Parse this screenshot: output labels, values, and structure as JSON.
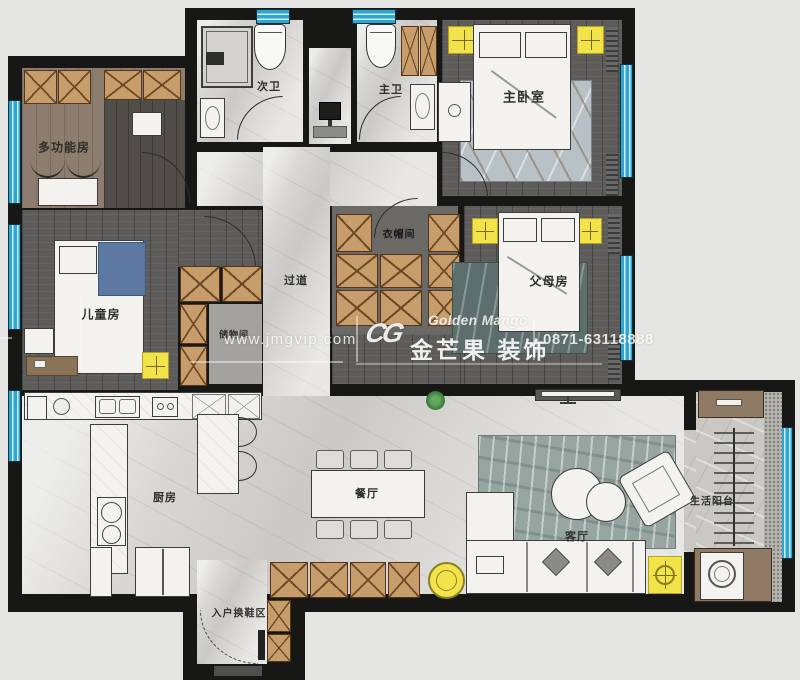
{
  "watermark": {
    "url": "www.jmgvip.com",
    "logo": "CG",
    "brand_en": "Golden Mango",
    "brand_cn": "金芒果 装饰",
    "phone": "0871-63118888"
  },
  "rooms": {
    "multi_function": {
      "label": "多功能房"
    },
    "second_bath": {
      "label": "次卫"
    },
    "master_bath": {
      "label": "主卫"
    },
    "master_bedroom": {
      "label": "主卧室"
    },
    "cloakroom": {
      "label": "衣帽间"
    },
    "parents_room": {
      "label": "父母房"
    },
    "children_room": {
      "label": "儿童房"
    },
    "storage": {
      "label": "储物间"
    },
    "corridor": {
      "label": "过道"
    },
    "kitchen": {
      "label": "厨房"
    },
    "dining": {
      "label": "餐厅"
    },
    "living": {
      "label": "客厅"
    },
    "balcony": {
      "label": "生活阳台"
    },
    "entry": {
      "label": "入户换鞋区"
    }
  },
  "colors": {
    "wall": "#171716",
    "window": "#2ea6cf",
    "cabinet": "#c79d6b",
    "ceiling_light": "#f3e34a",
    "floor_dark_wood": "#5d5c5a",
    "floor_marble": "#d8d7d4",
    "living_rug": "#97a5a1",
    "background": "#e5e5e3"
  }
}
